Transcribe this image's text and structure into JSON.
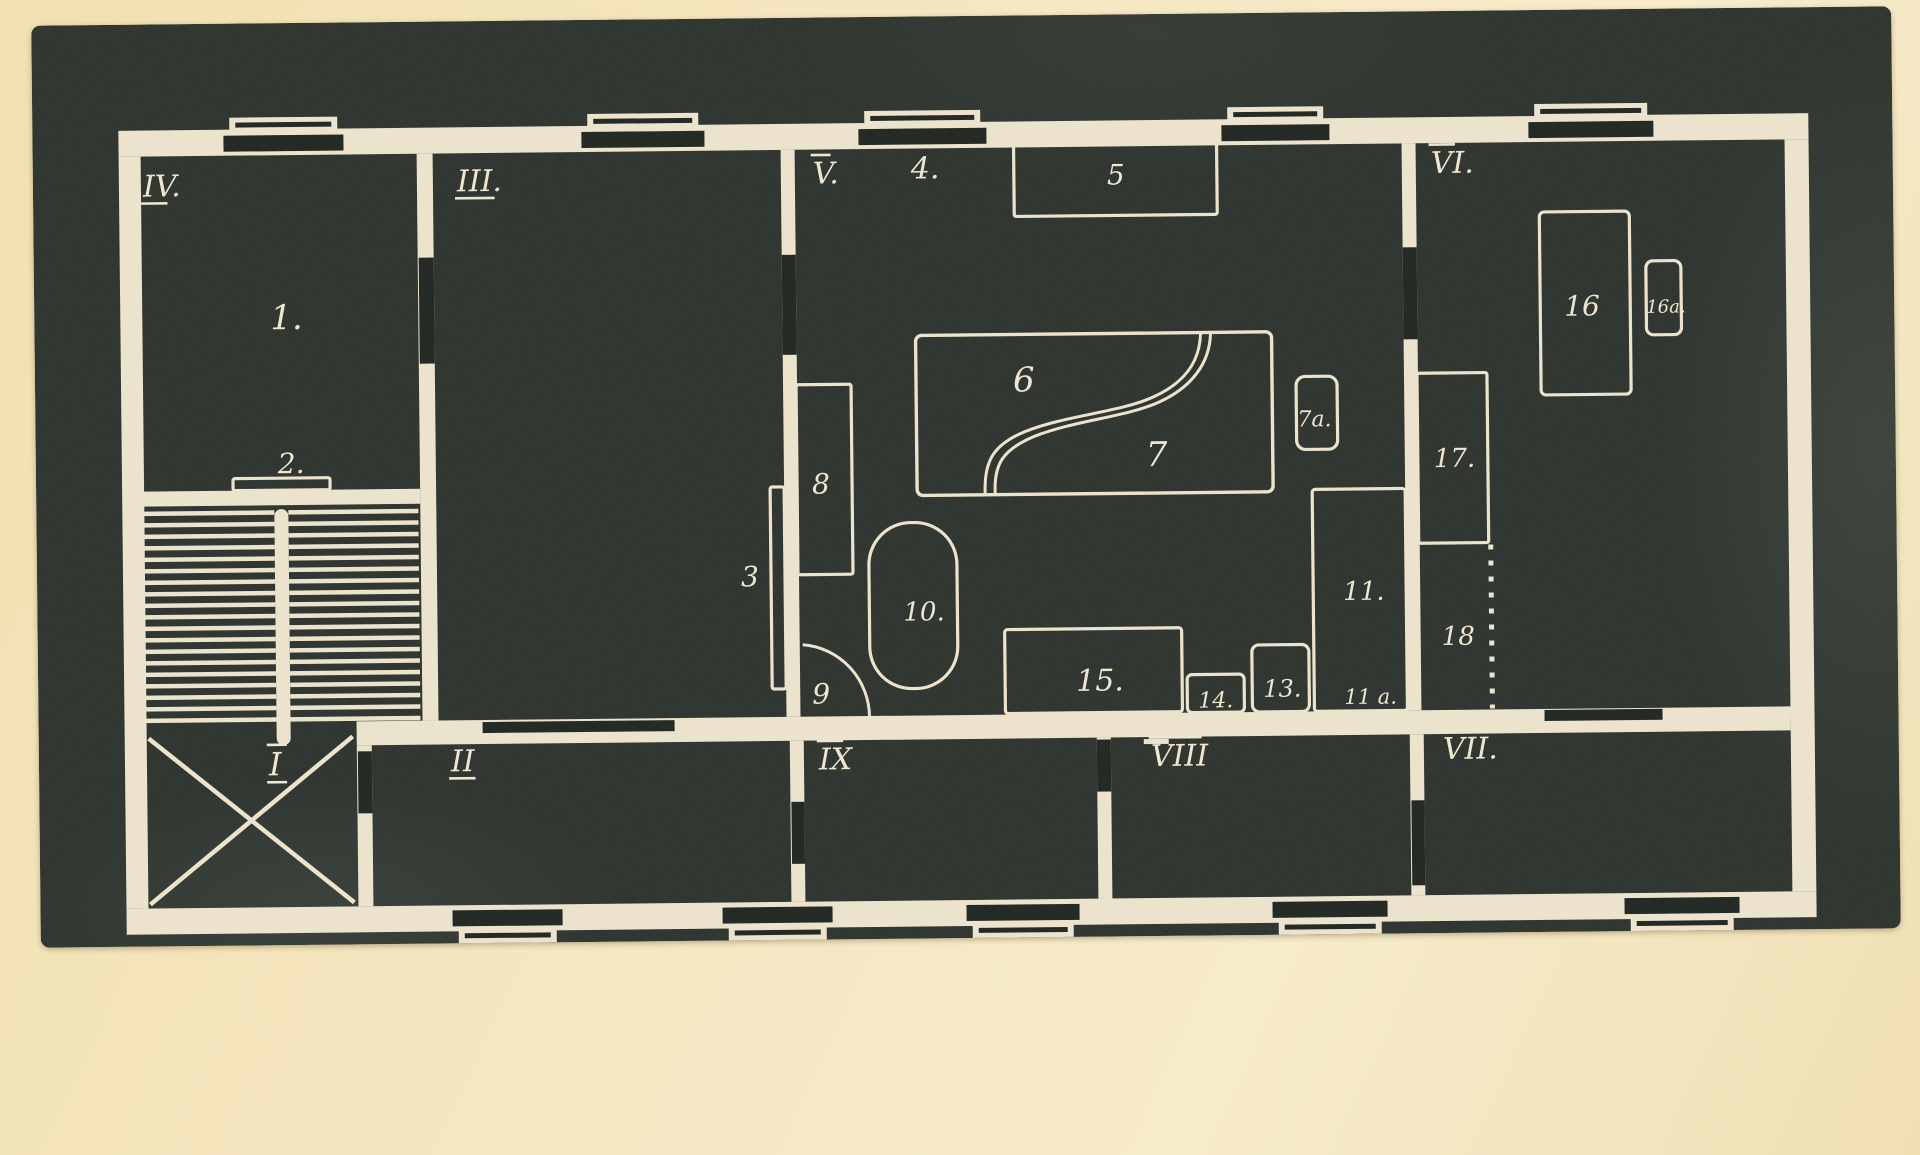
{
  "palette": {
    "paper": "#f3e5bf",
    "photo_dark": "#272d28",
    "line": "#ece2cc",
    "door_dark": "#1a201b",
    "label_ink": "#eee5cf"
  },
  "plan": {
    "outer_walls": [
      [
        122,
        122,
        1690,
        26
      ],
      [
        122,
        900,
        1690,
        26
      ],
      [
        122,
        148,
        22,
        752
      ],
      [
        1788,
        148,
        24,
        752
      ]
    ],
    "inner_walls": [
      [
        420,
        148,
        16,
        567
      ],
      [
        142,
        483,
        278,
        15
      ],
      [
        784,
        148,
        14,
        567
      ],
      [
        1405,
        148,
        14,
        567
      ],
      [
        354,
        715,
        1434,
        24
      ],
      [
        354,
        739,
        15,
        161
      ],
      [
        787,
        739,
        14,
        161
      ],
      [
        1094,
        739,
        14,
        161
      ],
      [
        1407,
        739,
        14,
        161
      ]
    ],
    "door_bars": [
      [
        421,
        252,
        15,
        106
      ],
      [
        784,
        253,
        14,
        100
      ],
      [
        1405,
        252,
        14,
        92
      ],
      [
        480,
        717,
        192,
        11
      ],
      [
        1542,
        716,
        118,
        11
      ],
      [
        1094,
        741,
        14,
        52
      ],
      [
        355,
        745,
        14,
        62
      ],
      [
        788,
        800,
        13,
        62
      ],
      [
        1408,
        805,
        13,
        85
      ]
    ],
    "top_windows": [
      [
        227,
        120
      ],
      [
        585,
        123
      ],
      [
        862,
        128
      ],
      [
        1225,
        108
      ],
      [
        1532,
        125
      ]
    ],
    "bottom_windows": [
      [
        448,
        110
      ],
      [
        718,
        110
      ],
      [
        962,
        113
      ],
      [
        1268,
        115
      ],
      [
        1620,
        115
      ]
    ],
    "stairs": {
      "left_flight": [
        142,
        274
      ],
      "right_flight": [
        288,
        418
      ],
      "tread_top": 503,
      "tread_bottom": 712,
      "tread_pitch": 11.5,
      "stringer": [
        274,
        502,
        14,
        236
      ]
    },
    "landing_cross": {
      "x1": 146,
      "y1": 730,
      "x2": 350,
      "y2": 896
    },
    "furniture": [
      {
        "name": "item-2",
        "rect": [
          233,
          471,
          97,
          12
        ],
        "r": 2
      },
      {
        "name": "item-5",
        "rect": [
          1017,
          143,
          203,
          74
        ],
        "r": 2
      },
      {
        "name": "item-3",
        "rect": [
          770,
          485,
          14,
          202
        ],
        "r": 2
      },
      {
        "name": "item-8",
        "rect": [
          797,
          383,
          55,
          190
        ],
        "r": 2
      },
      {
        "name": "item-10",
        "rect": [
          868,
          522,
          88,
          166
        ],
        "r": 42
      },
      {
        "name": "item-7a",
        "rect": [
          1297,
          380,
          41,
          73
        ],
        "r": 9
      },
      {
        "name": "item-15",
        "rect": [
          1003,
          630,
          177,
          84
        ],
        "r": 3
      },
      {
        "name": "item-14",
        "rect": [
          1185,
          677,
          57,
          38
        ],
        "r": 5
      },
      {
        "name": "item-13",
        "rect": [
          1250,
          648,
          57,
          67
        ],
        "r": 7
      },
      {
        "name": "item-11",
        "rect": [
          1312,
          493,
          93,
          222
        ],
        "r": 3
      },
      {
        "name": "item-17",
        "rect": [
          1418,
          378,
          70,
          170
        ],
        "r": 2
      },
      {
        "name": "item-16",
        "rect": [
          1542,
          218,
          90,
          183
        ],
        "r": 5
      },
      {
        "name": "item-16a",
        "rect": [
          1648,
          268,
          35,
          74
        ],
        "r": 7
      }
    ],
    "piano_unit": {
      "rect": [
        917,
        335,
        356,
        160
      ],
      "r": 6,
      "curve_a": "M985,494 C984,462 993,445 1026,432 C1068,416 1120,414 1154,399 C1186,385 1201,364 1202,336",
      "curve_b": "M995,494 C994,464 1003,450 1035,437 C1077,421 1126,419 1160,404 C1192,390 1211,366 1212,336"
    },
    "door_arc_9": "M801,643 A72,73 0 0 1 867,716",
    "door_tick": [
      1141,
      741,
      25,
      5
    ],
    "dashed_line_18": {
      "x": 1490,
      "y1": 550,
      "y2": 714
    },
    "room_labels": [
      {
        "text": "IV.",
        "x": 146,
        "y": 188,
        "decor": "under",
        "size": 30
      },
      {
        "text": "III.",
        "x": 460,
        "y": 186,
        "decor": "under",
        "size": 30
      },
      {
        "text": "V.",
        "x": 816,
        "y": 182,
        "decor": "over",
        "size": 30
      },
      {
        "text": "VI.",
        "x": 1434,
        "y": 178,
        "decor": "over",
        "size": 30
      },
      {
        "text": "I",
        "x": 266,
        "y": 768,
        "decor": "both",
        "size": 32
      },
      {
        "text": "II",
        "x": 448,
        "y": 766,
        "decor": "under",
        "size": 30
      },
      {
        "text": "IX",
        "x": 816,
        "y": 768,
        "decor": "over",
        "size": 30
      },
      {
        "text": "VIII",
        "x": 1148,
        "y": 768,
        "decor": "over",
        "size": 30
      },
      {
        "text": "VII.",
        "x": 1440,
        "y": 764,
        "decor": "over",
        "size": 30
      }
    ],
    "item_labels": [
      {
        "text": "1.",
        "x": 272,
        "y": 322,
        "size": 34
      },
      {
        "text": "2.",
        "x": 278,
        "y": 466,
        "size": 28
      },
      {
        "text": "3",
        "x": 740,
        "y": 584,
        "size": 28
      },
      {
        "text": "4.",
        "x": 914,
        "y": 178,
        "size": 30
      },
      {
        "text": "5",
        "x": 1110,
        "y": 186,
        "size": 28
      },
      {
        "text": "6",
        "x": 1014,
        "y": 392,
        "size": 34
      },
      {
        "text": "7",
        "x": 1146,
        "y": 468,
        "size": 34
      },
      {
        "text": "7a.",
        "x": 1298,
        "y": 430,
        "size": 22
      },
      {
        "text": "8",
        "x": 812,
        "y": 492,
        "size": 28
      },
      {
        "text": "9",
        "x": 810,
        "y": 702,
        "size": 28
      },
      {
        "text": "10.",
        "x": 902,
        "y": 620,
        "size": 26
      },
      {
        "text": "11.",
        "x": 1342,
        "y": 604,
        "size": 26
      },
      {
        "text": "11 a.",
        "x": 1342,
        "y": 708,
        "size": 21
      },
      {
        "text": "13.",
        "x": 1261,
        "y": 700,
        "size": 24
      },
      {
        "text": "14.",
        "x": 1196,
        "y": 710,
        "size": 22
      },
      {
        "text": "15.",
        "x": 1074,
        "y": 692,
        "size": 30
      },
      {
        "text": "16",
        "x": 1566,
        "y": 322,
        "size": 28
      },
      {
        "text": "16a.",
        "x": 1648,
        "y": 320,
        "size": 18
      },
      {
        "text": "17.",
        "x": 1434,
        "y": 472,
        "size": 26
      },
      {
        "text": "18",
        "x": 1440,
        "y": 650,
        "size": 26
      }
    ]
  }
}
